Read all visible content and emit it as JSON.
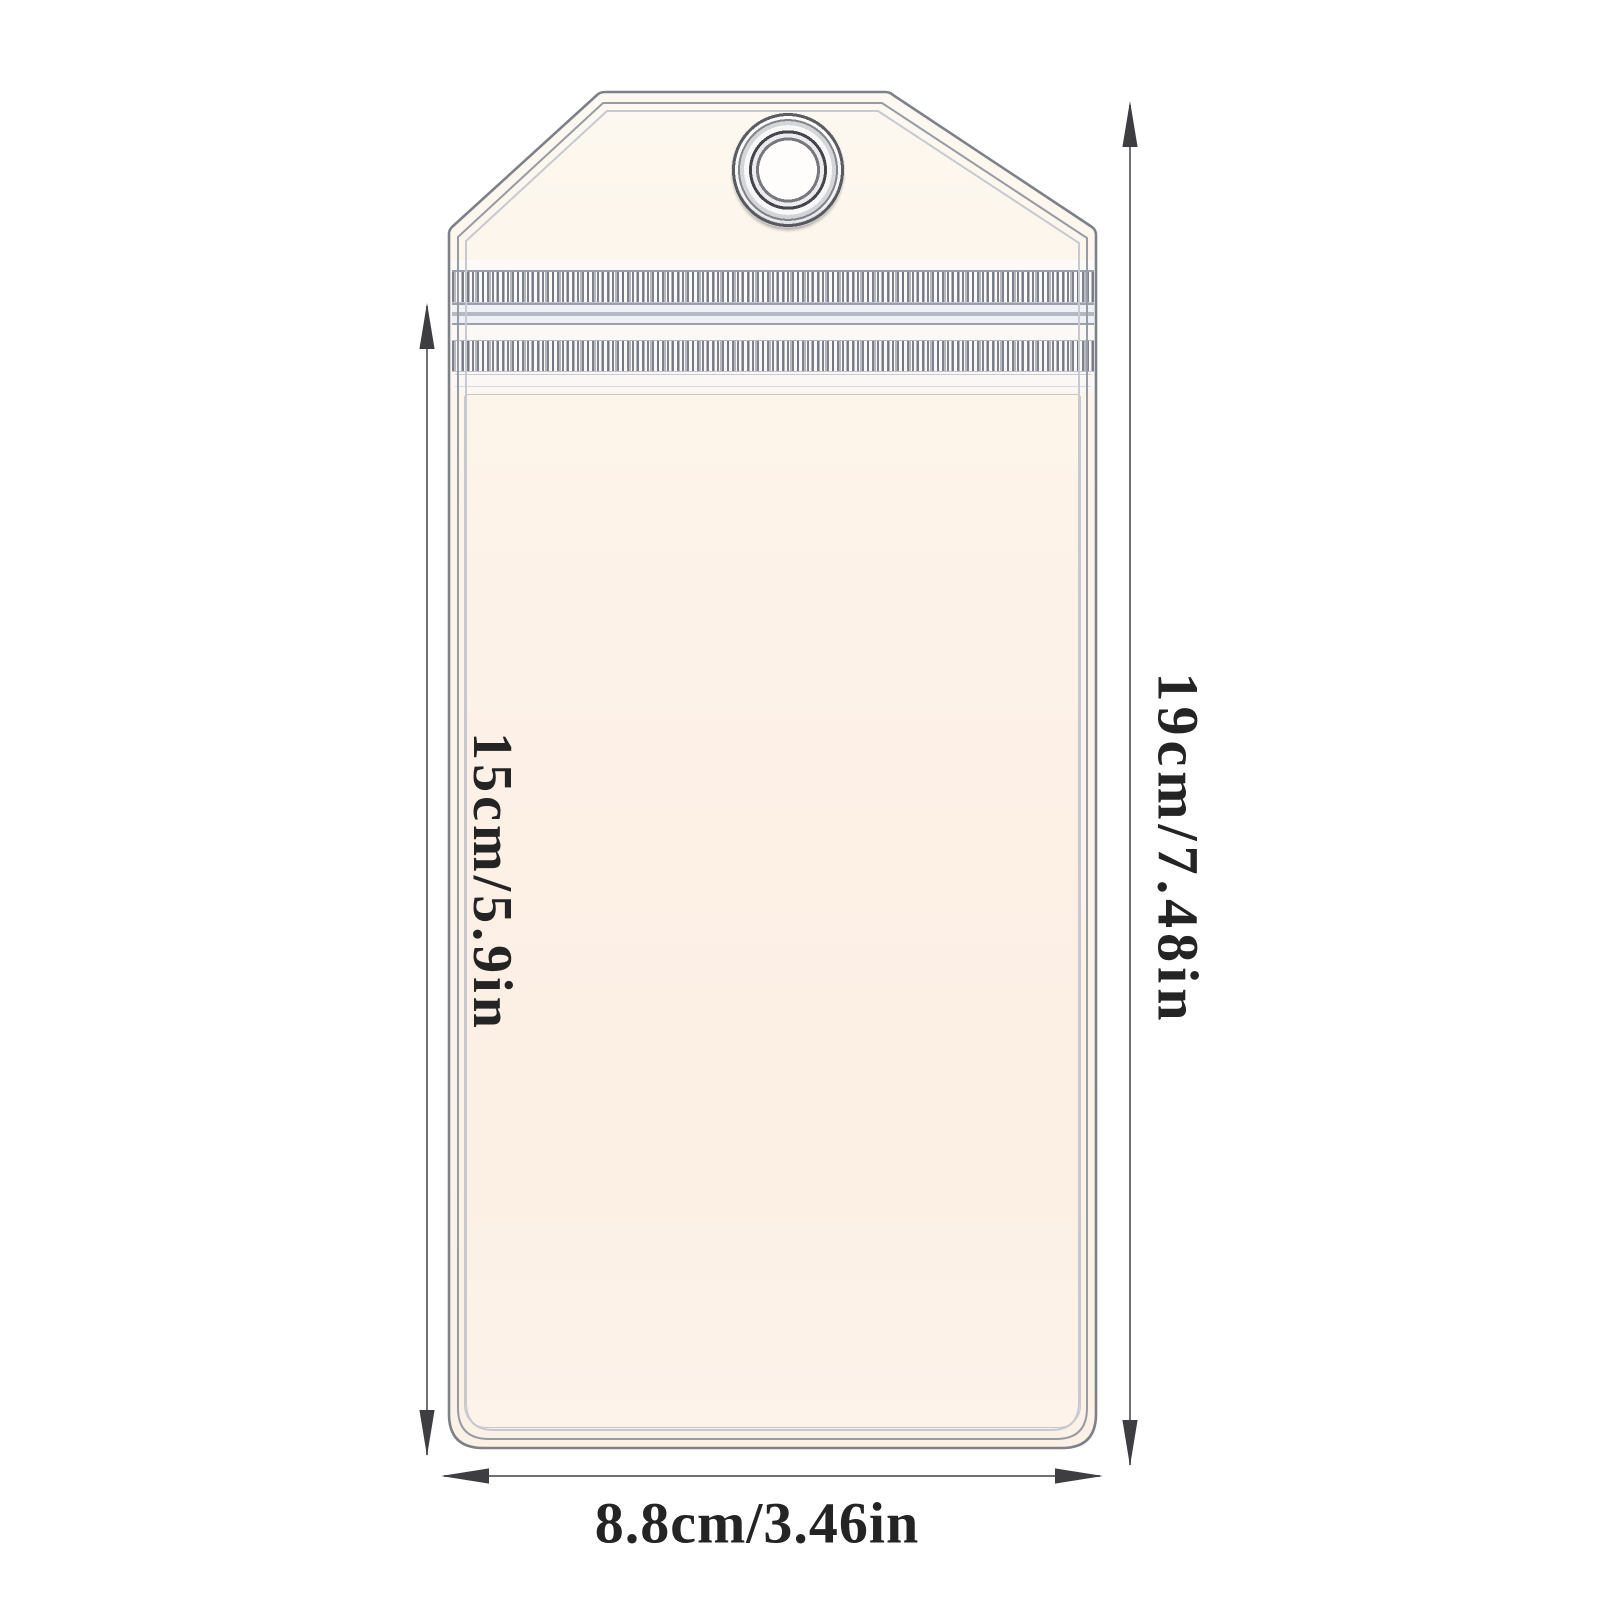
{
  "colors": {
    "background": "#ffffff",
    "bag-fill-top": "#fdf8f0",
    "bag-fill-bottom": "#fbf2e5",
    "panel-fill": "#fdf1e7",
    "bag-line": "#7d818c",
    "bag-line-inner": "#979ba6",
    "bag-line-faint": "#c6c9d2",
    "dim-line": "#717174",
    "arrow": "#3e3e42",
    "label-text": "#242424"
  },
  "dimensions": {
    "pouch_height": {
      "label": "15cm/5.9in"
    },
    "total_height": {
      "label": "19cm/7.48in"
    },
    "width": {
      "label": "8.8cm/3.46in"
    }
  }
}
